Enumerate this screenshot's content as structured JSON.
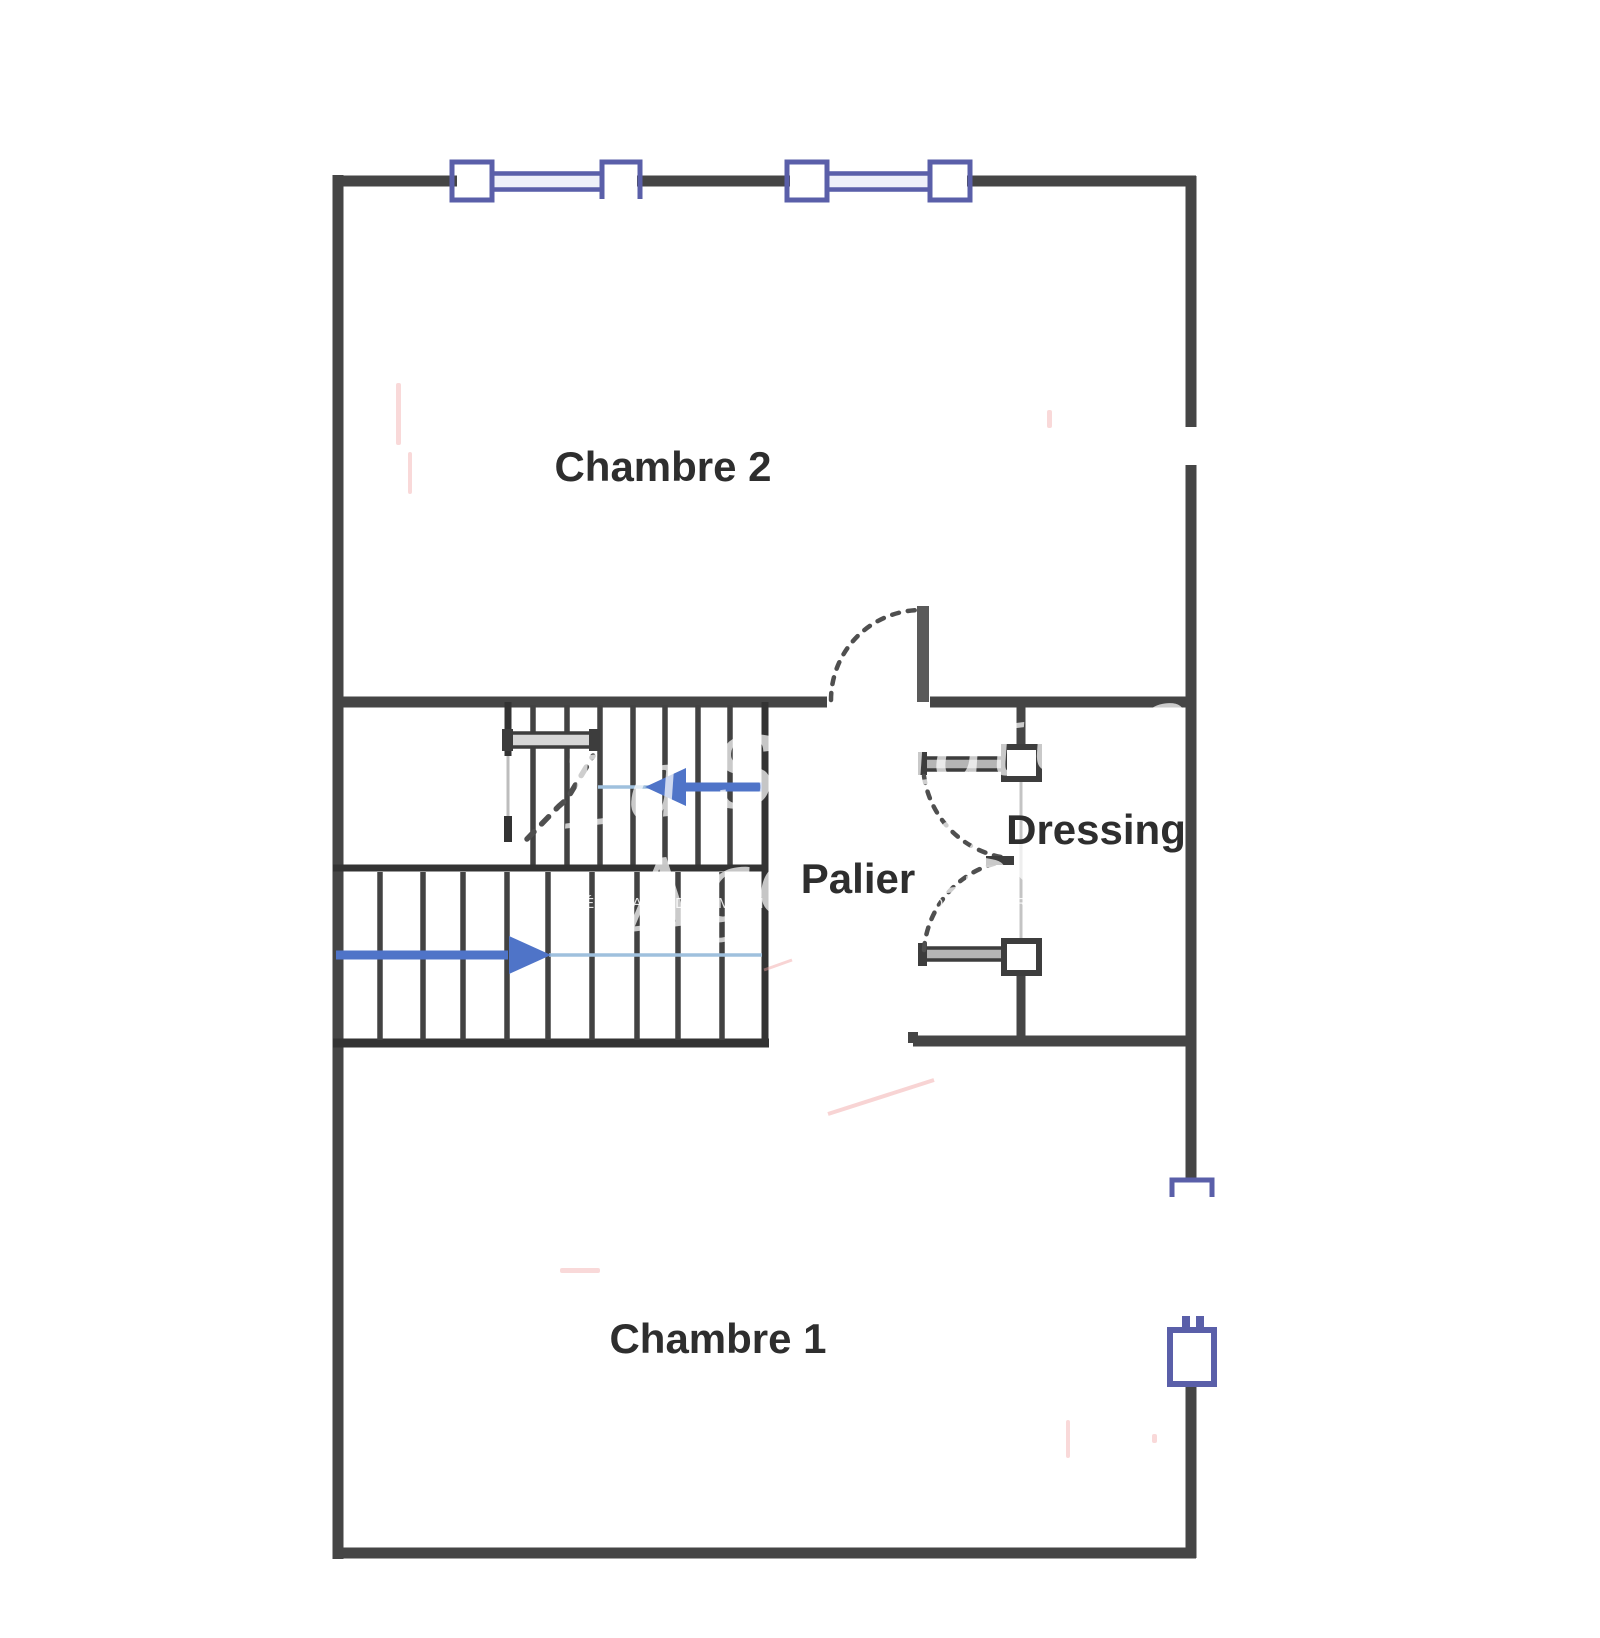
{
  "plan": {
    "type": "floor-plan",
    "language": "fr",
    "rooms": [
      {
        "id": "chambre2",
        "label": "Chambre 2"
      },
      {
        "id": "palier",
        "label": "Palier"
      },
      {
        "id": "dressing",
        "label": "Dressing"
      },
      {
        "id": "chambre1",
        "label": "Chambre 1"
      }
    ],
    "stairs": {
      "flights": 2,
      "upper_flight_arrow": "left",
      "lower_flight_arrow": "right"
    },
    "watermark": {
      "script_line_1": "La Signature",
      "script_line_2": "Agenaise",
      "tagline": "RÉSEAU DE MANDATAIRE IMMOBILIER"
    },
    "colors": {
      "wall": "#454545",
      "window-blue": "#5a5fa9",
      "window-fill": "#eef0f9",
      "arrow-blue": "#4f74c8",
      "arrow-light": "#9fc0dd",
      "label-text": "#2e2e2e",
      "dash": "#4f4f4f",
      "artifact-pink": "#ef9f9f"
    }
  }
}
